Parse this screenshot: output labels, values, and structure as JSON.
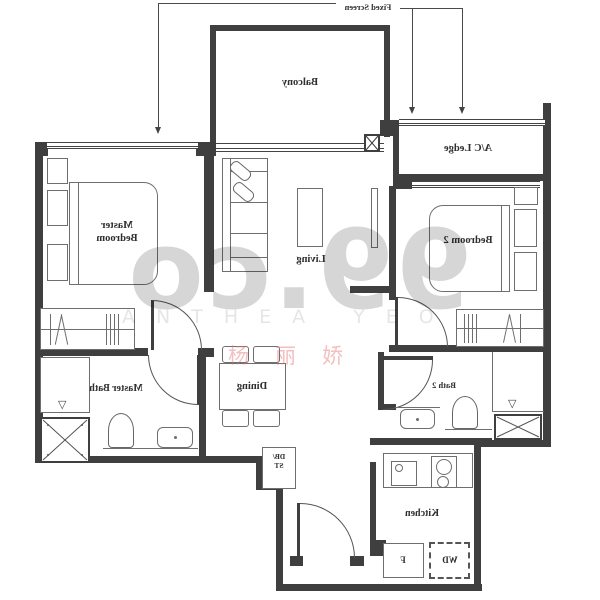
{
  "callout": {
    "fixed_screen": "Fixed Screen"
  },
  "rooms": {
    "balcony": "Balcony",
    "ac_ledge": "A/C Ledge",
    "master_bedroom": {
      "line1": "Master",
      "line2": "Bedroom"
    },
    "living": "Living",
    "bedroom2": "Bedroom 2",
    "master_bath": "Master Bath",
    "dining": "Dining",
    "bath2": "Bath 2",
    "kitchen": "Kitchen"
  },
  "fixtures": {
    "fridge": "F",
    "washer_dryer": "WD",
    "db_st": {
      "line1": "DB/",
      "line2": "ST"
    }
  },
  "watermark": {
    "brand": "99.co",
    "agent_latin": "ANTHEA YEO",
    "agent_cjk": "杨丽娇"
  },
  "colors": {
    "line": "#3f3f3f",
    "label": "#2e2e2e",
    "brand_watermark": "rgba(0,0,0,0.16)",
    "agent_watermark": "rgba(0,0,0,0.10)",
    "cjk_watermark": "rgba(226,116,116,0.45)"
  }
}
